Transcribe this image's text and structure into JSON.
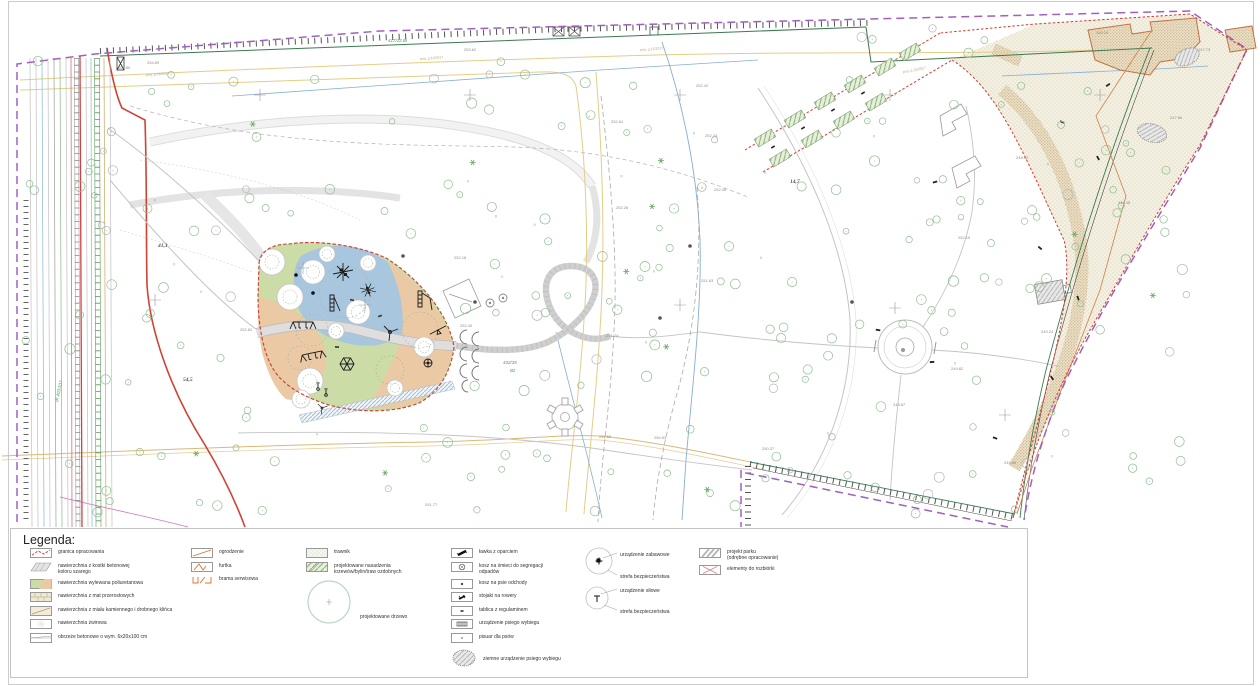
{
  "legend": {
    "title": "Legenda:",
    "col1": [
      {
        "label": "granica opracowania"
      },
      {
        "label": "nawierzchnia z kostki betonowej",
        "label2": "koloru szarego"
      },
      {
        "label": "nawierzchnia wylewana poliuretanowa"
      },
      {
        "label": "nawierzchnia z mat przerostowych"
      },
      {
        "label": "nawierzchnia z miału kamiennego i drobnego klińca"
      },
      {
        "label": "nawierzchnia żwirowa"
      },
      {
        "label": "obrzeże betonowe o wym. 6x20x100 cm"
      }
    ],
    "col2": [
      {
        "label": "ogrodzenie"
      },
      {
        "label": "furtka"
      },
      {
        "label": "brama serwisowa"
      }
    ],
    "col3": [
      {
        "label": "trawnik"
      },
      {
        "label": "projektowane nasadzenia",
        "label2": "krzewów/bylin/traw ozdobnych"
      },
      {
        "label": "projektowane drzewo"
      }
    ],
    "col4": [
      {
        "label": "ławka z oparciem"
      },
      {
        "label": "kosz na śmieci do segregacji",
        "label2": "odpadów"
      },
      {
        "label": "kosz na psie odchody"
      },
      {
        "label": "stojaki na rowery"
      },
      {
        "label": "tablica z regulaminem"
      },
      {
        "label": "urządzenie psiego wybiegu"
      },
      {
        "label": "pisuar dla psów"
      },
      {
        "label": "ziemne urządzenie psiego wybiegu"
      }
    ],
    "col5": [
      {
        "label": "urządzenie zabawowe",
        "zone": "strefa bezpieczeństwa"
      },
      {
        "label": "urządzenie siłowe",
        "zone": "strefa bezpieczeństwa"
      }
    ],
    "col6": [
      {
        "label": "projekt parku",
        "label2": "(odrębne opracowanie)"
      },
      {
        "label": "elementy do rozbiórki"
      }
    ]
  },
  "map": {
    "elevation_labels": [
      {
        "text": "254.80",
        "x": 118,
        "y": 69
      },
      {
        "text": "254.89",
        "x": 147,
        "y": 64
      },
      {
        "text": "253.62",
        "x": 464,
        "y": 51
      },
      {
        "text": "252.42",
        "x": 696,
        "y": 87
      },
      {
        "text": "252.64",
        "x": 611,
        "y": 123
      },
      {
        "text": "252.24",
        "x": 705,
        "y": 137
      },
      {
        "text": "252.06",
        "x": 714,
        "y": 191
      },
      {
        "text": "252.26",
        "x": 616,
        "y": 209
      },
      {
        "text": "252.18",
        "x": 454,
        "y": 259
      },
      {
        "text": "252.82",
        "x": 240,
        "y": 331
      },
      {
        "text": "252.40",
        "x": 460,
        "y": 327
      },
      {
        "text": "251.74",
        "x": 606,
        "y": 337
      },
      {
        "text": "251.63",
        "x": 701,
        "y": 282
      },
      {
        "text": "251.50",
        "x": 599,
        "y": 438
      },
      {
        "text": "251.77",
        "x": 425,
        "y": 506
      },
      {
        "text": "252.19",
        "x": 958,
        "y": 239
      },
      {
        "text": "250.93",
        "x": 654,
        "y": 439
      },
      {
        "text": "250.37",
        "x": 762,
        "y": 450
      },
      {
        "text": "249.86",
        "x": 1004,
        "y": 464
      },
      {
        "text": "249.82",
        "x": 951,
        "y": 370
      },
      {
        "text": "249.87",
        "x": 893,
        "y": 406
      },
      {
        "text": "249.24",
        "x": 1041,
        "y": 333
      },
      {
        "text": "248.24",
        "x": 1096,
        "y": 34
      },
      {
        "text": "247.73",
        "x": 1198,
        "y": 51
      },
      {
        "text": "247.86",
        "x": 1170,
        "y": 119
      },
      {
        "text": "248.48",
        "x": 1118,
        "y": 204
      },
      {
        "text": "248.82",
        "x": 1016,
        "y": 159
      }
    ],
    "area_labels": [
      {
        "text": "41,1",
        "x": 158,
        "y": 247
      },
      {
        "text": "54,5",
        "x": 183,
        "y": 381
      },
      {
        "text": "14,7",
        "x": 790,
        "y": 183
      }
    ],
    "parcel_labels": [
      {
        "text": "417/22  Bi",
        "x": 388,
        "y": 42
      },
      {
        "text": "432/35",
        "x": 503,
        "y": 364
      },
      {
        "text": "Bz",
        "x": 510,
        "y": 372
      },
      {
        "text": "dr 403/107",
        "x": 58,
        "y": 402,
        "rot": -78
      }
    ],
    "utility_labels": [
      {
        "text": "proj. g 12/2017",
        "x": 146,
        "y": 76,
        "rot": -4
      },
      {
        "text": "proj. g 12/2017",
        "x": 420,
        "y": 60,
        "rot": -4
      },
      {
        "text": "proj. g 12/2017",
        "x": 640,
        "y": 51,
        "rot": -4
      },
      {
        "text": "proj. g 12/2017",
        "x": 903,
        "y": 73,
        "rot": -10
      }
    ]
  },
  "colors": {
    "playground_blue": "#a9c6df",
    "playground_green": "#cbdca6",
    "playground_orange": "#ebc9a4",
    "boundary_purple": "#a060c0",
    "boundary_red": "#c9473b",
    "path_gray": "#dedede",
    "tree_green": "#90bd90"
  }
}
